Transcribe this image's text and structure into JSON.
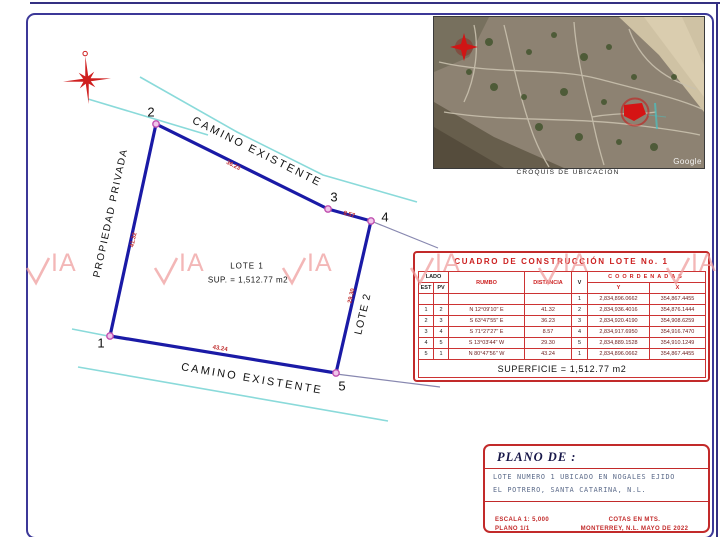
{
  "drawing": {
    "labels": {
      "camino_top": "CAMINO EXISTENTE",
      "camino_bottom": "CAMINO EXISTENTE",
      "propiedad": "PROPIEDAD PRIVADA",
      "lote1": "LOTE 1",
      "lote1_sup": "SUP. = 1,512.77 m2",
      "lote2": "LOTE 2"
    },
    "vertices": {
      "v1": "1",
      "v2": "2",
      "v3": "3",
      "v4": "4",
      "v5": "5"
    },
    "distances": {
      "d12": "41.32",
      "d23": "36.23",
      "d34": "8.57",
      "d45": "29.30",
      "d51": "43.24"
    }
  },
  "inset": {
    "caption": "CROQUIS DE UBICACION",
    "google": "Google"
  },
  "watermark": {
    "label": "IA"
  },
  "table": {
    "title": "CUADRO DE CONSTRUCCIÓN LOTE No. 1",
    "headers": {
      "lado": "LADO",
      "est": "EST",
      "pv": "PV",
      "rumbo": "RUMBO",
      "distancia": "DISTANCIA",
      "v": "V",
      "coordenadas": "COORDENADAS",
      "y": "Y",
      "x": "X"
    },
    "rows": [
      {
        "est": "",
        "pv": "",
        "rumbo": "",
        "dist": "",
        "v": "1",
        "y": "2,834,896.0662",
        "x": "354,867.4455"
      },
      {
        "est": "1",
        "pv": "2",
        "rumbo": "N 12°09'10\" E",
        "dist": "41.32",
        "v": "2",
        "y": "2,834,936.4016",
        "x": "354,876.1444"
      },
      {
        "est": "2",
        "pv": "3",
        "rumbo": "S 63°47'55\" E",
        "dist": "36.23",
        "v": "3",
        "y": "2,834,920.4190",
        "x": "354,908.6259"
      },
      {
        "est": "3",
        "pv": "4",
        "rumbo": "S 71°27'27\" E",
        "dist": "8.57",
        "v": "4",
        "y": "2,834,917.6950",
        "x": "354,916.7470"
      },
      {
        "est": "4",
        "pv": "5",
        "rumbo": "S 13°03'44\" W",
        "dist": "29.30",
        "v": "5",
        "y": "2,834,889.1528",
        "x": "354,910.1249"
      },
      {
        "est": "5",
        "pv": "1",
        "rumbo": "N 80°47'56\" W",
        "dist": "43.24",
        "v": "1",
        "y": "2,834,896.0662",
        "x": "354,867.4455"
      }
    ],
    "superficie": "SUPERFICIE = 1,512.77 m2"
  },
  "titleblock": {
    "plano_de": "PLANO DE :",
    "line1": "LOTE NUMERO 1 UBICADO EN NOGALES EJIDO",
    "line2": "EL POTRERO, SANTA CATARINA, N.L.",
    "escala": "ESCALA 1: 5,000",
    "plano_num": "PLANO 1/1",
    "cotas": "COTAS EN MTS.",
    "lugar_fecha": "MONTERREY, N.L. MAYO DE 2022"
  },
  "colors": {
    "border_blue": "#3c3898",
    "table_red": "#c22a2a",
    "polygon_blue": "#1a1aa6",
    "road_cyan": "#8adada",
    "watermark_pink": "#f0a0a0",
    "star_red": "#cf1f1f"
  }
}
